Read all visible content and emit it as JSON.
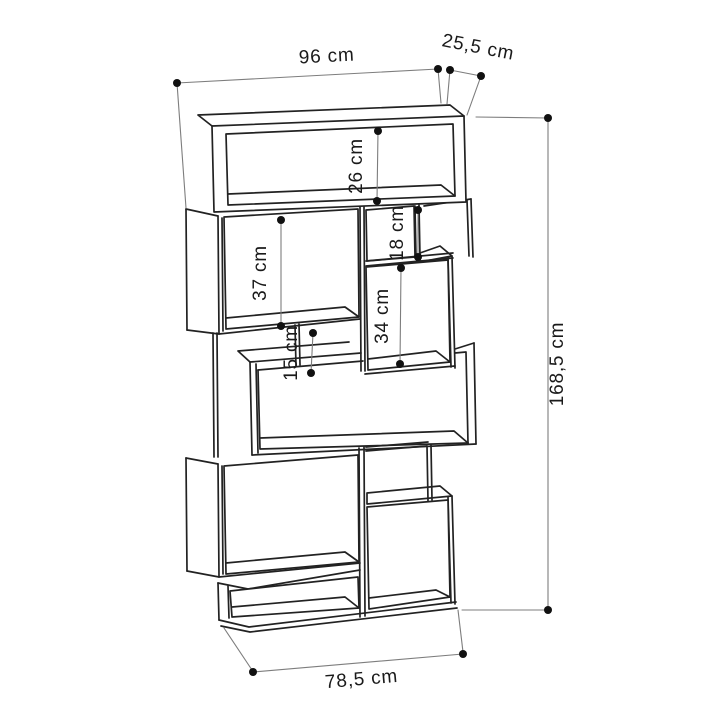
{
  "diagram": {
    "type": "furniture-dimension-drawing",
    "subject": "staggered zigzag bookcase with open compartments",
    "background_color": "#ffffff",
    "drawing_line_color": "#222222",
    "dimension_line_color": "#7d7d7d",
    "dimension_dot_color": "#111111",
    "text_color": "#1a1a1a",
    "units": "cm",
    "dimensions": {
      "total_width": {
        "label": "96 cm",
        "value": 96
      },
      "depth": {
        "label": "25,5 cm",
        "value": 25.5
      },
      "top_compartment_height": {
        "label": "26 cm",
        "value": 26
      },
      "upper_left_compartment_height": {
        "label": "37 cm",
        "value": 37
      },
      "small_right_compartment_height": {
        "label": "18 cm",
        "value": 18
      },
      "middle_gap_height": {
        "label": "15 cm",
        "value": 15
      },
      "mid_right_compartment_height": {
        "label": "34 cm",
        "value": 34
      },
      "total_height": {
        "label": "168,5 cm",
        "value": 168.5
      },
      "row_width": {
        "label": "78,5 cm",
        "value": 78.5
      }
    }
  }
}
